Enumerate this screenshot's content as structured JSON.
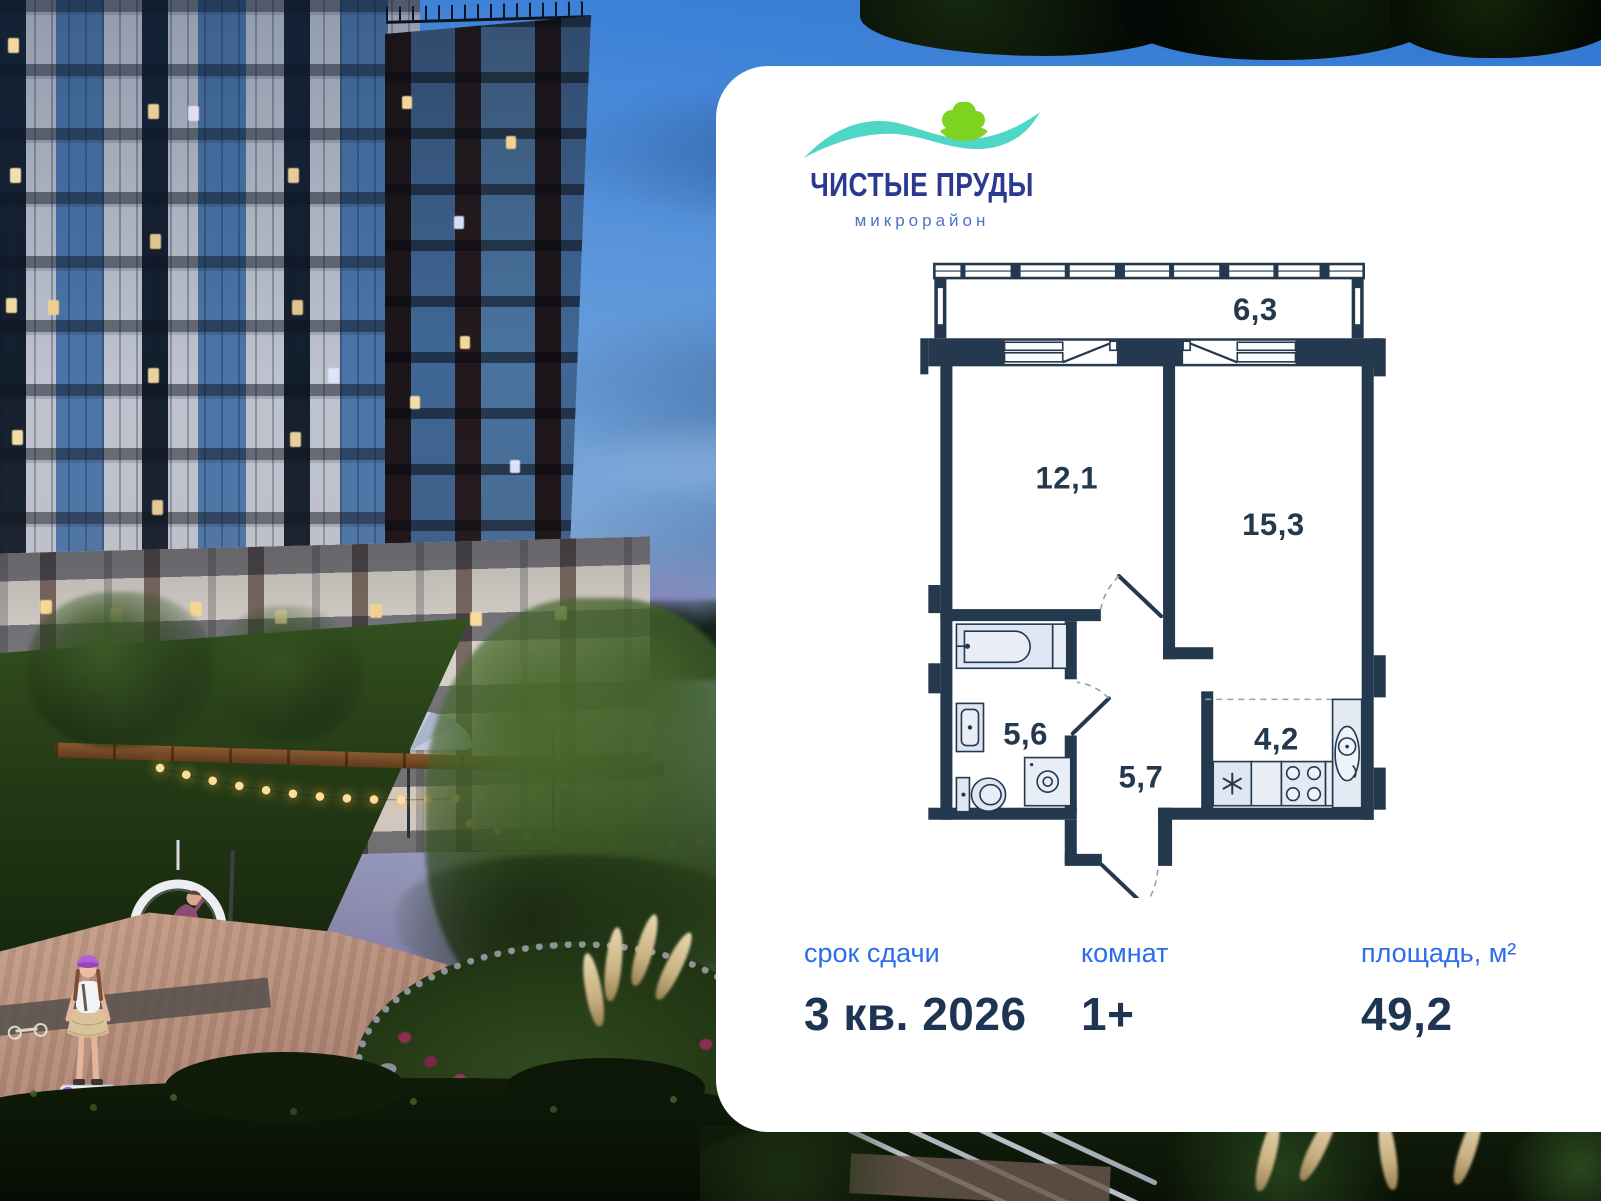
{
  "logo": {
    "title": "ЧИСТЫЕ ПРУДЫ",
    "subtitle": "микрорайон"
  },
  "photo": {
    "entrance_sign": "Подъезд 3"
  },
  "floor_plan": {
    "balcony_area": "6,3",
    "bedroom_area": "12,1",
    "living_room_area": "15,3",
    "bathroom_area": "5,6",
    "hallway_area": "5,7",
    "kitchen_area": "4,2"
  },
  "details": {
    "deadline_label": "срок сдачи",
    "deadline_value": "3 кв. 2026",
    "rooms_label": "комнат",
    "rooms_value": "1+",
    "area_label": "площадь, м²",
    "area_value": "49,2"
  },
  "colors": {
    "label_blue": "#2C6DE8",
    "value_navy": "#1D3452",
    "plan_wall_navy": "#24384E",
    "logo_indigo": "#2B3A8F",
    "logo_teal": "#4ED7C6",
    "logo_green": "#7ED321"
  }
}
